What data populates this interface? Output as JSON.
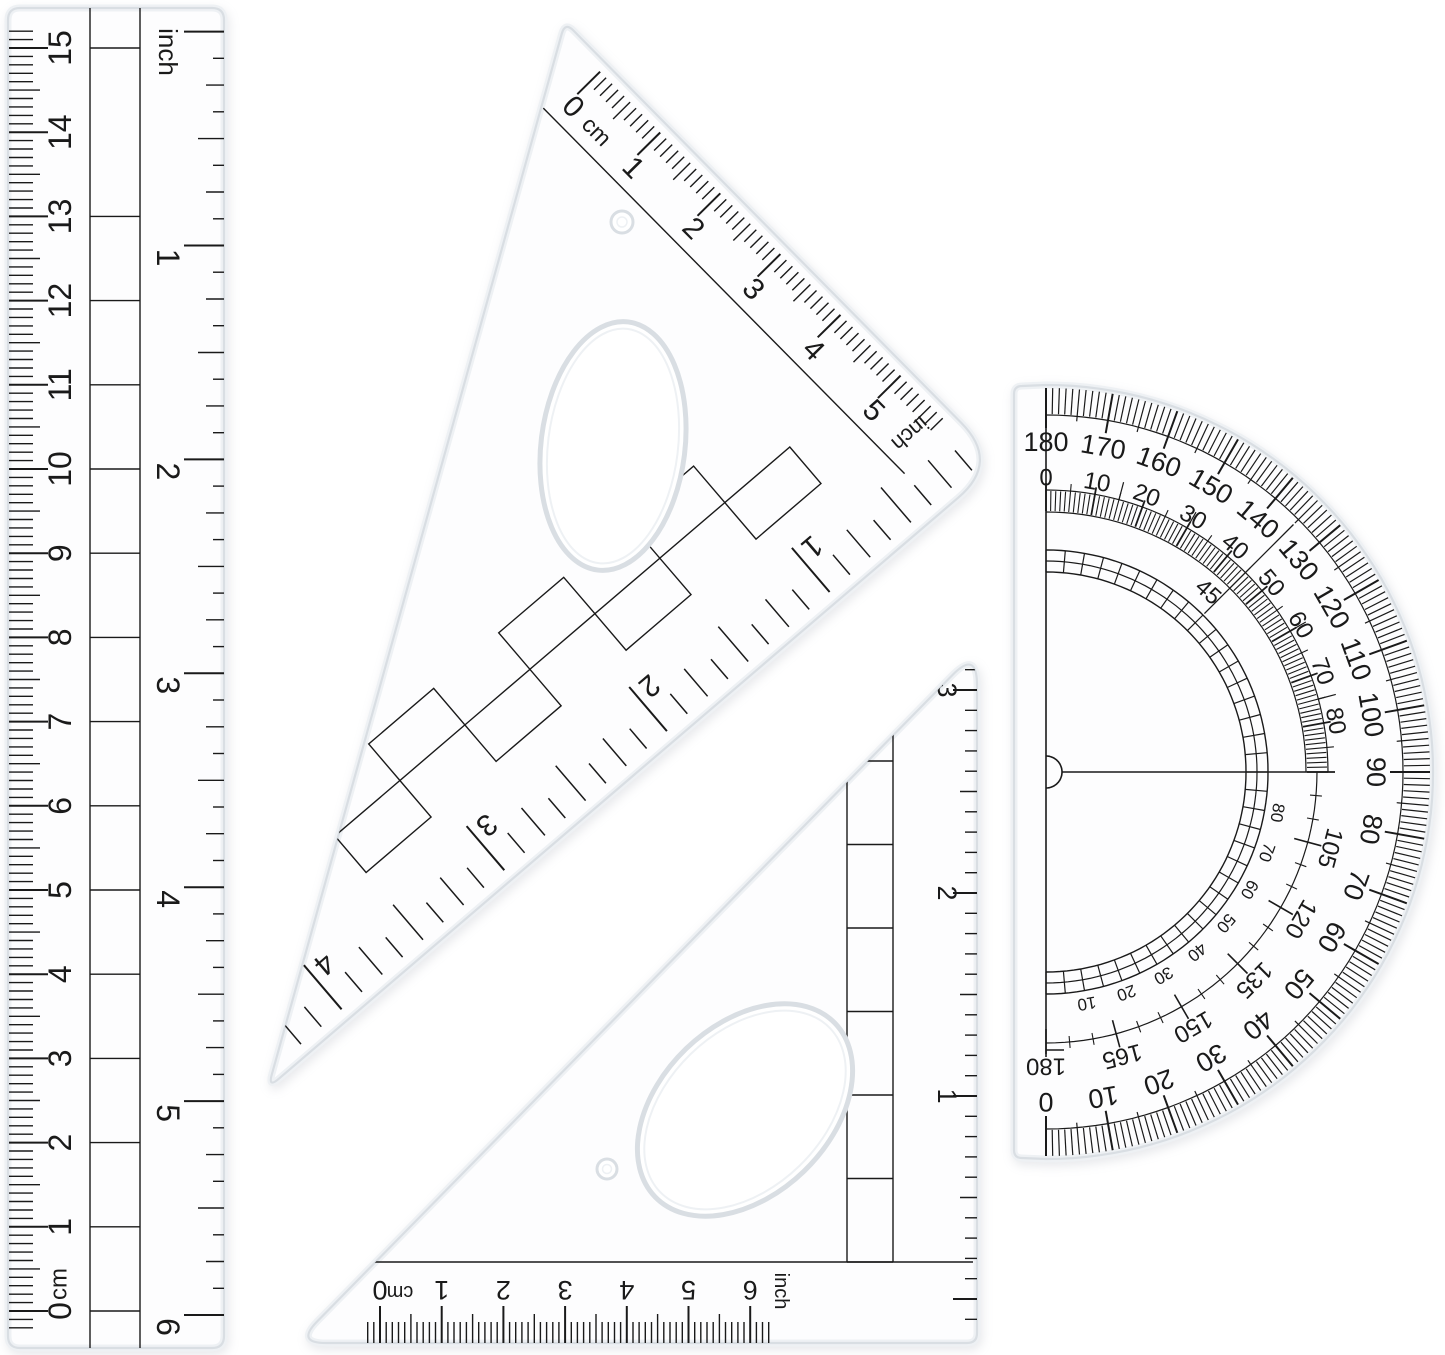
{
  "image": {
    "width": 1445,
    "height": 1355,
    "background": "#ffffff"
  },
  "colors": {
    "ink": "#1a1a1a",
    "plastic_fill": "#fdfdfe",
    "plastic_edge": "#d9dee3",
    "plastic_soft": "#eef1f4",
    "background": "#ffffff"
  },
  "ruler": {
    "cm_labels": [
      "0",
      "1",
      "2",
      "3",
      "4",
      "5",
      "6",
      "7",
      "8",
      "9",
      "10",
      "11",
      "12",
      "13",
      "14",
      "15"
    ],
    "cm_unit": "cm",
    "inch_labels": [
      "1",
      "2",
      "3",
      "4",
      "5",
      "6"
    ],
    "inch_unit": "inch"
  },
  "triangle_large": {
    "cm_labels": [
      "0",
      "1",
      "2",
      "3",
      "4",
      "5"
    ],
    "cm_unit": "cm",
    "inch_labels": [
      "1",
      "2",
      "3",
      "4"
    ],
    "inch_unit": "inch"
  },
  "triangle_small": {
    "cm_labels": [
      "0",
      "1",
      "2",
      "3",
      "4",
      "5",
      "6"
    ],
    "cm_unit": "cm",
    "inch_labels": [
      "1",
      "2",
      "3"
    ],
    "inch_unit": "inch"
  },
  "protractor": {
    "outer_labels": [
      "0",
      "10",
      "20",
      "30",
      "40",
      "50",
      "60",
      "70",
      "80",
      "90",
      "100",
      "110",
      "120",
      "130",
      "140",
      "150",
      "160",
      "170",
      "180"
    ],
    "inner_top_labels": [
      "0",
      "10",
      "20",
      "30",
      "40",
      "50",
      "60",
      "70",
      "80"
    ],
    "inner_bottom_labels": [
      "105",
      "120",
      "135",
      "150",
      "165",
      "180"
    ],
    "band_labels": [
      "10",
      "20",
      "30",
      "40",
      "50",
      "60",
      "70",
      "80"
    ],
    "bisector_label": "45"
  }
}
